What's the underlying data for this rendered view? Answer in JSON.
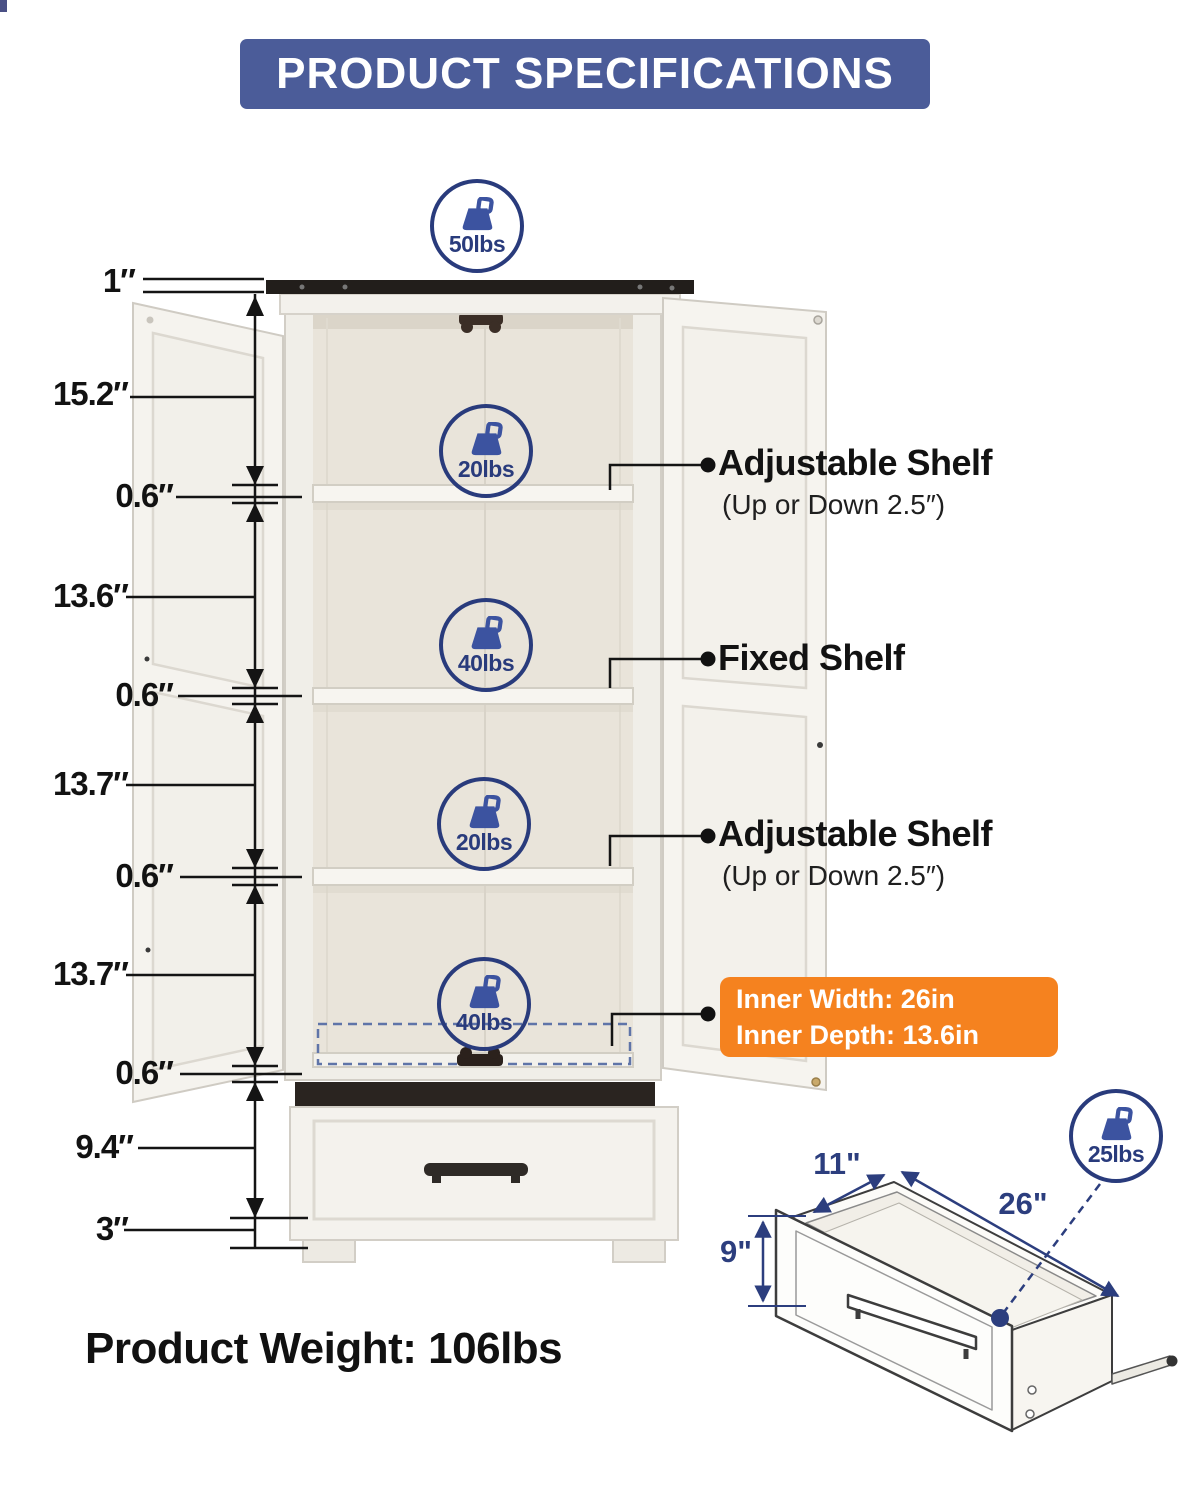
{
  "header": {
    "title": "PRODUCT SPECIFICATIONS"
  },
  "side_dimensions": [
    "1″",
    "15.2″",
    "0.6″",
    "13.6″",
    "0.6″",
    "13.7″",
    "0.6″",
    "13.7″",
    "0.6″",
    "9.4″",
    "3″"
  ],
  "callouts": [
    {
      "title": "Adjustable Shelf",
      "subtitle": "(Up or Down 2.5″)"
    },
    {
      "title": "Fixed Shelf",
      "subtitle": ""
    },
    {
      "title": "Adjustable Shelf",
      "subtitle": "(Up or Down 2.5″)"
    }
  ],
  "inner_dimensions": {
    "width": "Inner Width: 26in",
    "depth": "Inner Depth: 13.6in"
  },
  "weight_capacities": {
    "top": "50lbs",
    "upper_shelf": "20lbs",
    "middle_shelf": "40lbs",
    "lower_shelf": "20lbs",
    "bottom_shelf": "40lbs",
    "drawer": "25lbs"
  },
  "drawer_dimensions": {
    "depth": "11\"",
    "width": "26\"",
    "height": "9\""
  },
  "product_weight": "Product Weight: 106lbs",
  "colors": {
    "header_bg": "#4b5c99",
    "accent_blue": "#2c3e7e",
    "icon_blue": "#3c53a0",
    "highlight_orange": "#f5821f",
    "cabinet_top_dark": "#221e1b",
    "text_black": "#121212"
  }
}
